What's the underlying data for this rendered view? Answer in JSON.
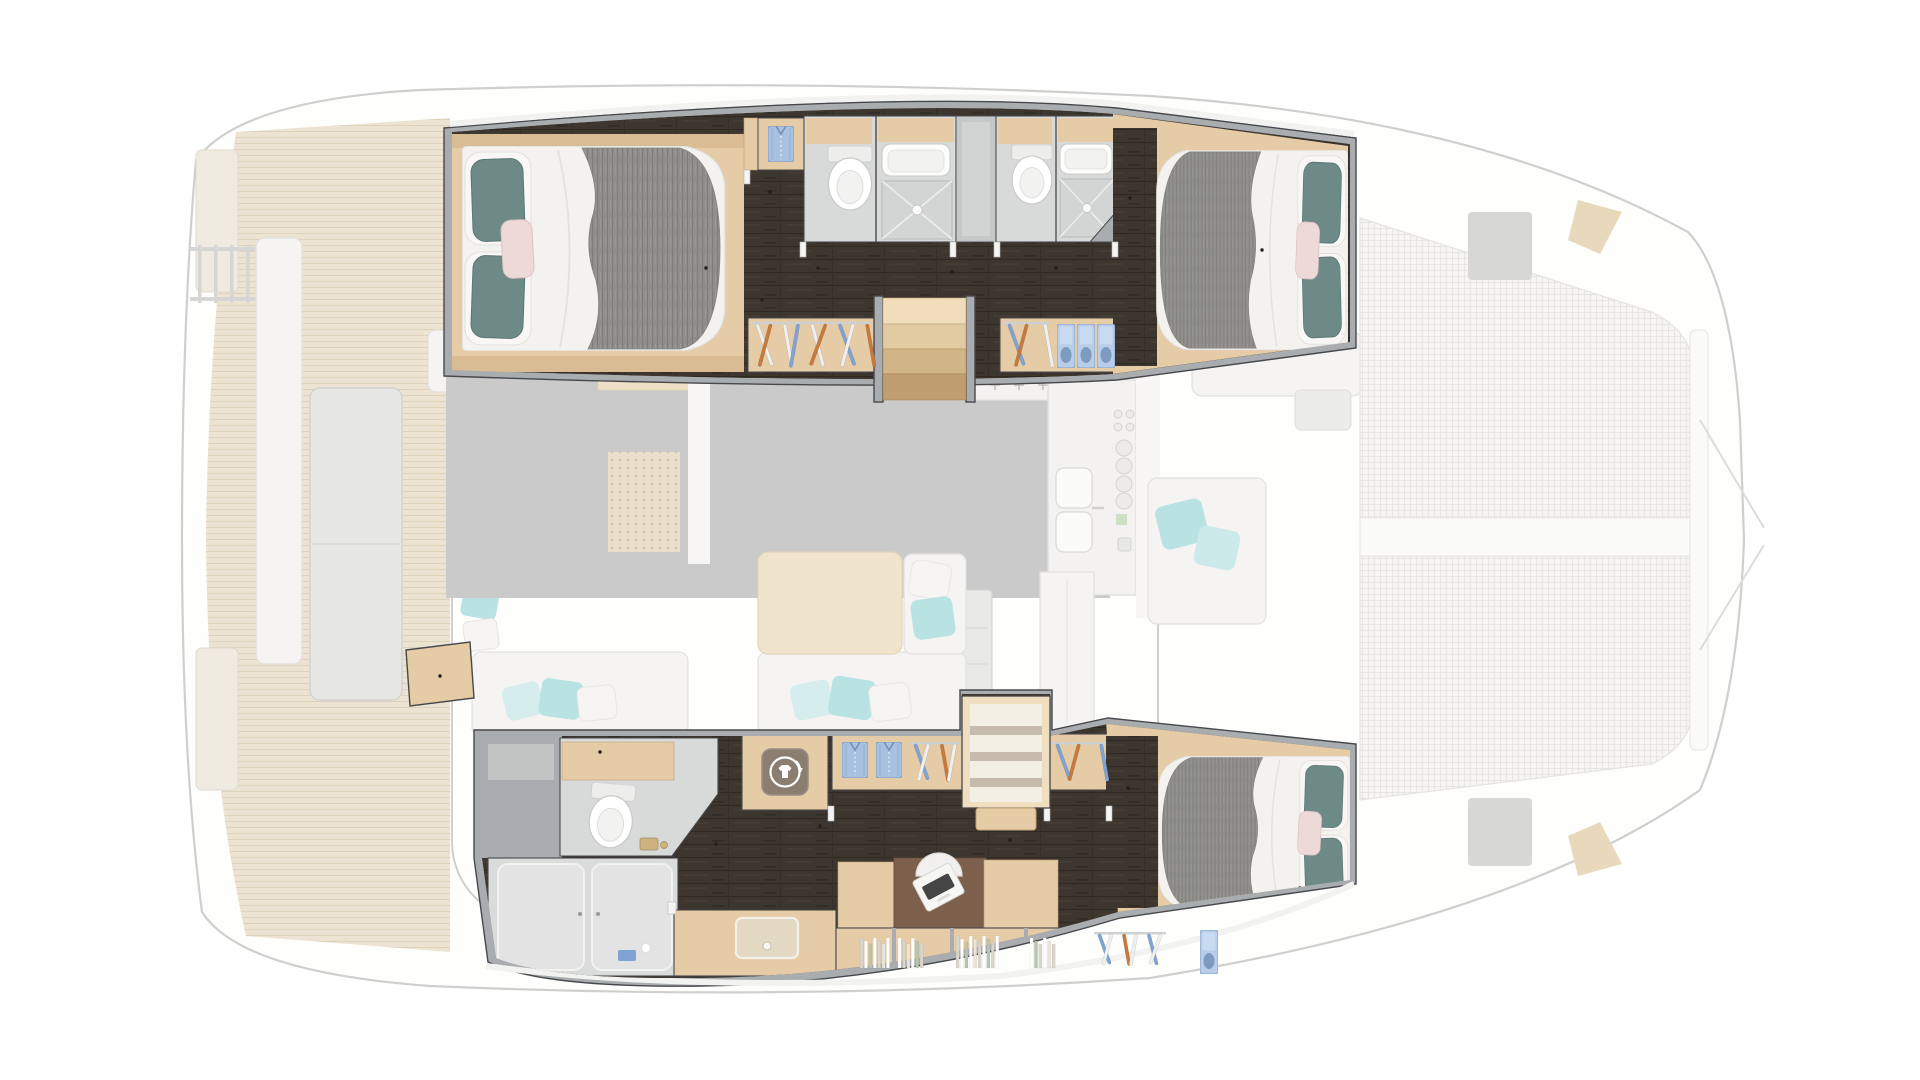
{
  "meta": {
    "description": "Top-down 3D floor plan of a sailing catamaran, 3-cabin layout. Hull interiors rendered crisp; saloon, aft cockpit and foredeck trampolines shown faded/ghosted.",
    "canvas": {
      "width": 1920,
      "height": 1080
    }
  },
  "palette": {
    "wall": "#a9adb0",
    "wallEdge": "#46484b",
    "deckStrip": "#f2f2f0",
    "floorDark": "#3d362f",
    "floorDarkLine": "#2e2922",
    "floorDarkLite": "#483f36",
    "wood": "#e5cba6",
    "woodLight": "#efdec0",
    "woodDark": "#c2a277",
    "step1": "#efddbb",
    "step2": "#e2cba2",
    "step3": "#d2b587",
    "step4": "#c09e6f",
    "bath": "#d8dada",
    "bathEdge": "#b7b9b9",
    "fixture": "#fdfdfc",
    "fixtureLine": "#c9c9c7",
    "fixtureInner": "#f2f2f1",
    "duvet": "#f3f2ef",
    "duvetLine": "#e4e2de",
    "blanket": "#8f8e8b",
    "blanketLine": "#7e7d7a",
    "pillowWhite": "#f8f7f5",
    "pillowTeal": "#6d8a87",
    "pillowTealDark": "#5a7674",
    "pillowPink": "#eed9d9",
    "hangerBlue": "#7fa3d4",
    "hangerOrange": "#c8793c",
    "hangerWhite": "#efefed",
    "rod": "#cdd1d3",
    "shirtBlue": "#a9c1e1",
    "shirtBlueDark": "#7d9ac1",
    "laundryBox": "#8b7d6f",
    "laundryGlyph": "#ffffff",
    "desk": "#7c604b",
    "laptop": "#f6f6f5",
    "keyboard": "#454545",
    "chair": "#f1f0ee",
    "bookA": "#d9d5c9",
    "bookB": "#ffffff",
    "bookC": "#b9c4ae",
    "bookD": "#e9e5da",
    "shelfBg": "#f4efe5",
    "fadeTeak": "#ece3d2",
    "fadeTeakLine": "#ded2ba",
    "fadeFloor": "#c9cac9",
    "fadeFurn": "#f5f4f2",
    "fadeFurnLine": "#e2e1df",
    "fadeWood": "#eee0c8",
    "fadeLine": "#cfcfcd",
    "fadePillow": "#b9e2e2",
    "mesh": "#f6f5f3",
    "meshLine": "#e4e2de",
    "hullFill": "#fefefd",
    "grayHatch": "#d7d7d5",
    "anchorWedge": "#e8d9bd",
    "counter": "#f3f2f0",
    "island": "#e9e9e7"
  },
  "vessel": {
    "port_hull": {
      "rooms": [
        {
          "id": "aft-cabin",
          "name": "Port aft guest cabin with double berth"
        },
        {
          "id": "bathroom-aft",
          "name": "Guest bathroom with toilet, washbasin and shower"
        },
        {
          "id": "companionway-locker",
          "name": "Side locker between bathrooms"
        },
        {
          "id": "bathroom-fwd",
          "name": "Guest bathroom with toilet, washbasin and shower"
        },
        {
          "id": "fwd-cabin",
          "name": "Port forward guest cabin with double berth"
        },
        {
          "id": "wardrobe-aft",
          "name": "Hanging wardrobe"
        },
        {
          "id": "stairs",
          "name": "Companionway steps down from saloon"
        },
        {
          "id": "wardrobe-fwd",
          "name": "Hanging wardrobe with folded-clothes cubbies"
        }
      ]
    },
    "starboard_hull": {
      "rooms": [
        {
          "id": "owner-bathroom",
          "name": "Owner's bathroom with toilet"
        },
        {
          "id": "shower-room",
          "name": "Separate walk-in shower"
        },
        {
          "id": "laundry",
          "name": "Washing machine locker"
        },
        {
          "id": "wardrobe-mid",
          "name": "Wardrobe with folded shirts and hangers"
        },
        {
          "id": "stairs-shelves",
          "name": "Companionway steps with open shelving"
        },
        {
          "id": "wardrobe-small",
          "name": "Hanging wardrobe"
        },
        {
          "id": "office",
          "name": "Desk with laptop and chair"
        },
        {
          "id": "bookshelf",
          "name": "Bookshelf lockers"
        },
        {
          "id": "vanity",
          "name": "Vanity counter with washbasin"
        },
        {
          "id": "owner-cabin",
          "name": "Starboard forward owner's cabin with double berth"
        }
      ]
    },
    "faded_areas": [
      {
        "id": "hull-outline",
        "name": "Catamaran hull and deck outline (dimmed)"
      },
      {
        "id": "aft-deck",
        "name": "Aft cockpit with table and bench seating (dimmed)"
      },
      {
        "id": "saloon",
        "name": "Saloon with galley, nav station, sofa and dining table (dimmed)"
      },
      {
        "id": "foredeck",
        "name": "Foredeck with twin trampolines (dimmed)"
      }
    ]
  },
  "decor": [
    {
      "type": "shirt",
      "x": 768,
      "y": 126
    },
    {
      "type": "hangers",
      "x": 752,
      "y": 322,
      "w": 120,
      "h": 50,
      "colors": [
        "w",
        "o",
        "w",
        "b",
        "w",
        "o",
        "b",
        "w",
        "o"
      ]
    },
    {
      "type": "hangers",
      "x": 1004,
      "y": 322,
      "w": 46,
      "h": 50,
      "colors": [
        "b",
        "o",
        "w"
      ]
    },
    {
      "type": "cubby",
      "x": 1057,
      "y": 324
    },
    {
      "type": "cubby",
      "x": 1077,
      "y": 324
    },
    {
      "type": "cubby",
      "x": 1097,
      "y": 324
    },
    {
      "type": "laundry",
      "x": 785,
      "y": 772
    },
    {
      "type": "shirt",
      "x": 842,
      "y": 742
    },
    {
      "type": "shirt",
      "x": 876,
      "y": 742
    },
    {
      "type": "hangers",
      "x": 910,
      "y": 742,
      "w": 50,
      "h": 44,
      "colors": [
        "b",
        "w",
        "o",
        "w"
      ]
    },
    {
      "type": "hangers",
      "x": 1052,
      "y": 742,
      "w": 54,
      "h": 44,
      "colors": [
        "b",
        "o",
        "b"
      ]
    },
    {
      "type": "books",
      "x": 860,
      "y": 934,
      "h": 34,
      "spines": [
        "a",
        "b",
        "c",
        "b",
        "a",
        "d",
        "b"
      ]
    },
    {
      "type": "books",
      "x": 898,
      "y": 934,
      "h": 34,
      "spines": [
        "b",
        "a",
        "d",
        "b",
        "c",
        "a"
      ]
    },
    {
      "type": "books",
      "x": 956,
      "y": 932,
      "h": 36,
      "spines": [
        "a",
        "b",
        "c",
        "b",
        "d",
        "a",
        "b",
        "c",
        "a",
        "b"
      ]
    },
    {
      "type": "books",
      "x": 1030,
      "y": 934,
      "h": 34,
      "spines": [
        "b",
        "c",
        "a",
        "b",
        "d",
        "a"
      ]
    },
    {
      "type": "hangers",
      "x": 1094,
      "y": 932,
      "w": 72,
      "h": 38,
      "colors": [
        "b",
        "w",
        "o",
        "w",
        "b",
        "w"
      ]
    },
    {
      "type": "cubby",
      "x": 1200,
      "y": 930
    }
  ]
}
